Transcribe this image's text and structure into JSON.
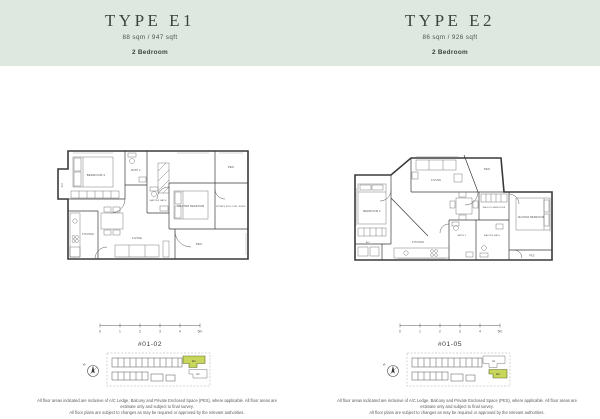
{
  "theme": {
    "band_color": "#dee7e0",
    "title_color": "#39443e",
    "wall_color": "#3a3a3a",
    "highlight_green": "#c8d75b",
    "highlight_border": "#5f6d2a"
  },
  "columns": [
    {
      "title": "TYPE E1",
      "area": "88 sqm / 947 sqft",
      "bedrooms": "2 Bedroom",
      "unit_no": "#01-02",
      "compass": "N",
      "scale_ticks": [
        "0",
        "1",
        "2",
        "3",
        "4",
        "5m"
      ],
      "keyplan": {
        "highlight": "E1",
        "secondary": "E2"
      },
      "rooms": {
        "ac": "A/C",
        "bedroom2": "BEDROOM 2",
        "bath2": "BATH 2",
        "master_bath": "MASTER BATH",
        "pes_top": "PES",
        "master_bedroom": "MASTER BEDROOM",
        "pes_side": "PRIVATE ENCLOSED SPACE",
        "kitchen": "KITCHEN",
        "living": "LIVING",
        "pes_bottom": "PES"
      }
    },
    {
      "title": "TYPE E2",
      "area": "86 sqm / 926 sqft",
      "bedrooms": "2 Bedroom",
      "unit_no": "#01-05",
      "compass": "N",
      "scale_ticks": [
        "0",
        "1",
        "2",
        "3",
        "4",
        "5m"
      ],
      "keyplan": {
        "highlight": "E2",
        "secondary": "E1"
      },
      "rooms": {
        "living": "LIVING",
        "pes_top": "PES",
        "bedroom2": "BEDROOM 2",
        "walk_in": "WALK-IN WARDROBE",
        "master_bedroom": "MASTER BEDROOM",
        "kitchen": "KITCHEN",
        "bath2": "BATH 2",
        "master_bath": "MASTER BATH",
        "pes_bottom": "PES",
        "ac": "A/C"
      }
    }
  ],
  "footer": {
    "line1": "All floor areas indicated are inclusive of A/C Ledge, Balcony and Private Enclosed Space (PES), where applicable. All floor areas are estimate only and subject to final survey.",
    "line2": "All floor plans are subject to changes as may be required or approved by the relevant authorities."
  }
}
